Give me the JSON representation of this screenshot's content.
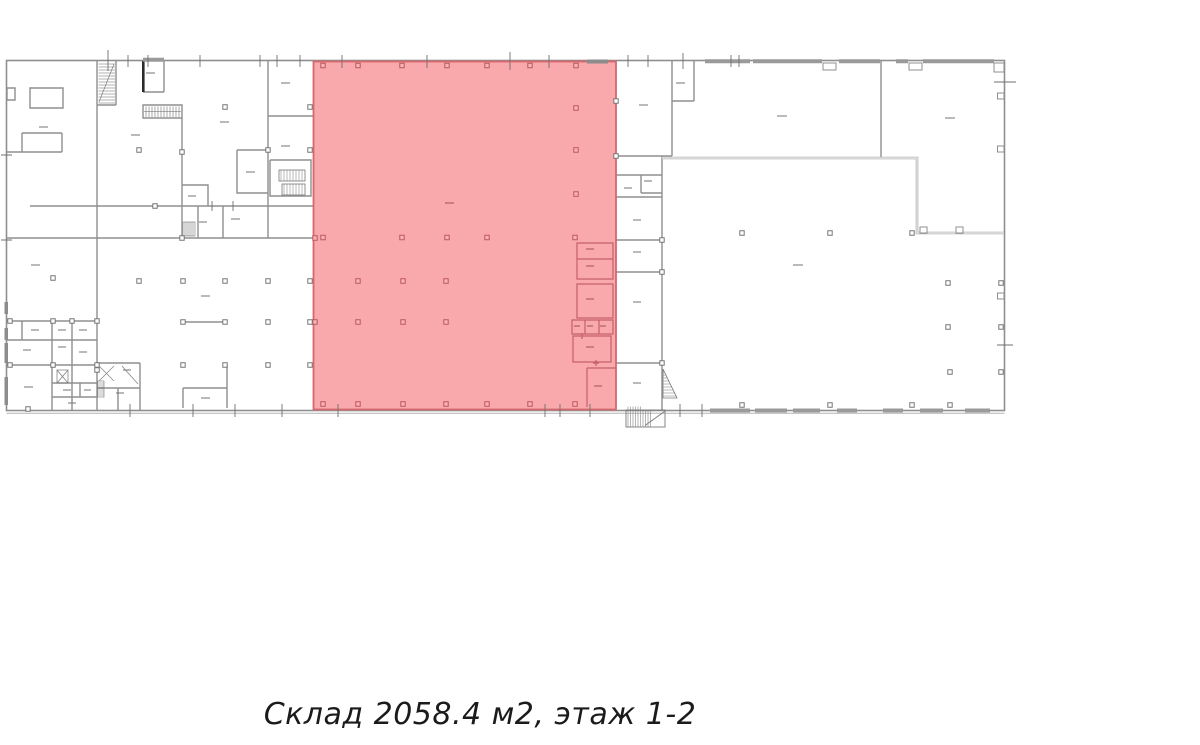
{
  "caption": {
    "text": "Склад 2058.4 м2, этаж 1-2"
  },
  "unit": {
    "type": "Склад",
    "area": "2058.4 м2",
    "floors": "этаж 1-2"
  },
  "plan": {
    "background": "#FFFFFF",
    "wall_color": "#8F8F8F",
    "wall_thick_color": "#9A9A9A",
    "highlight": {
      "fill": "#F9A8AC",
      "border": "#D4686F",
      "inner_wall_color": "#C4606A",
      "column_color": "#BD565E"
    }
  }
}
